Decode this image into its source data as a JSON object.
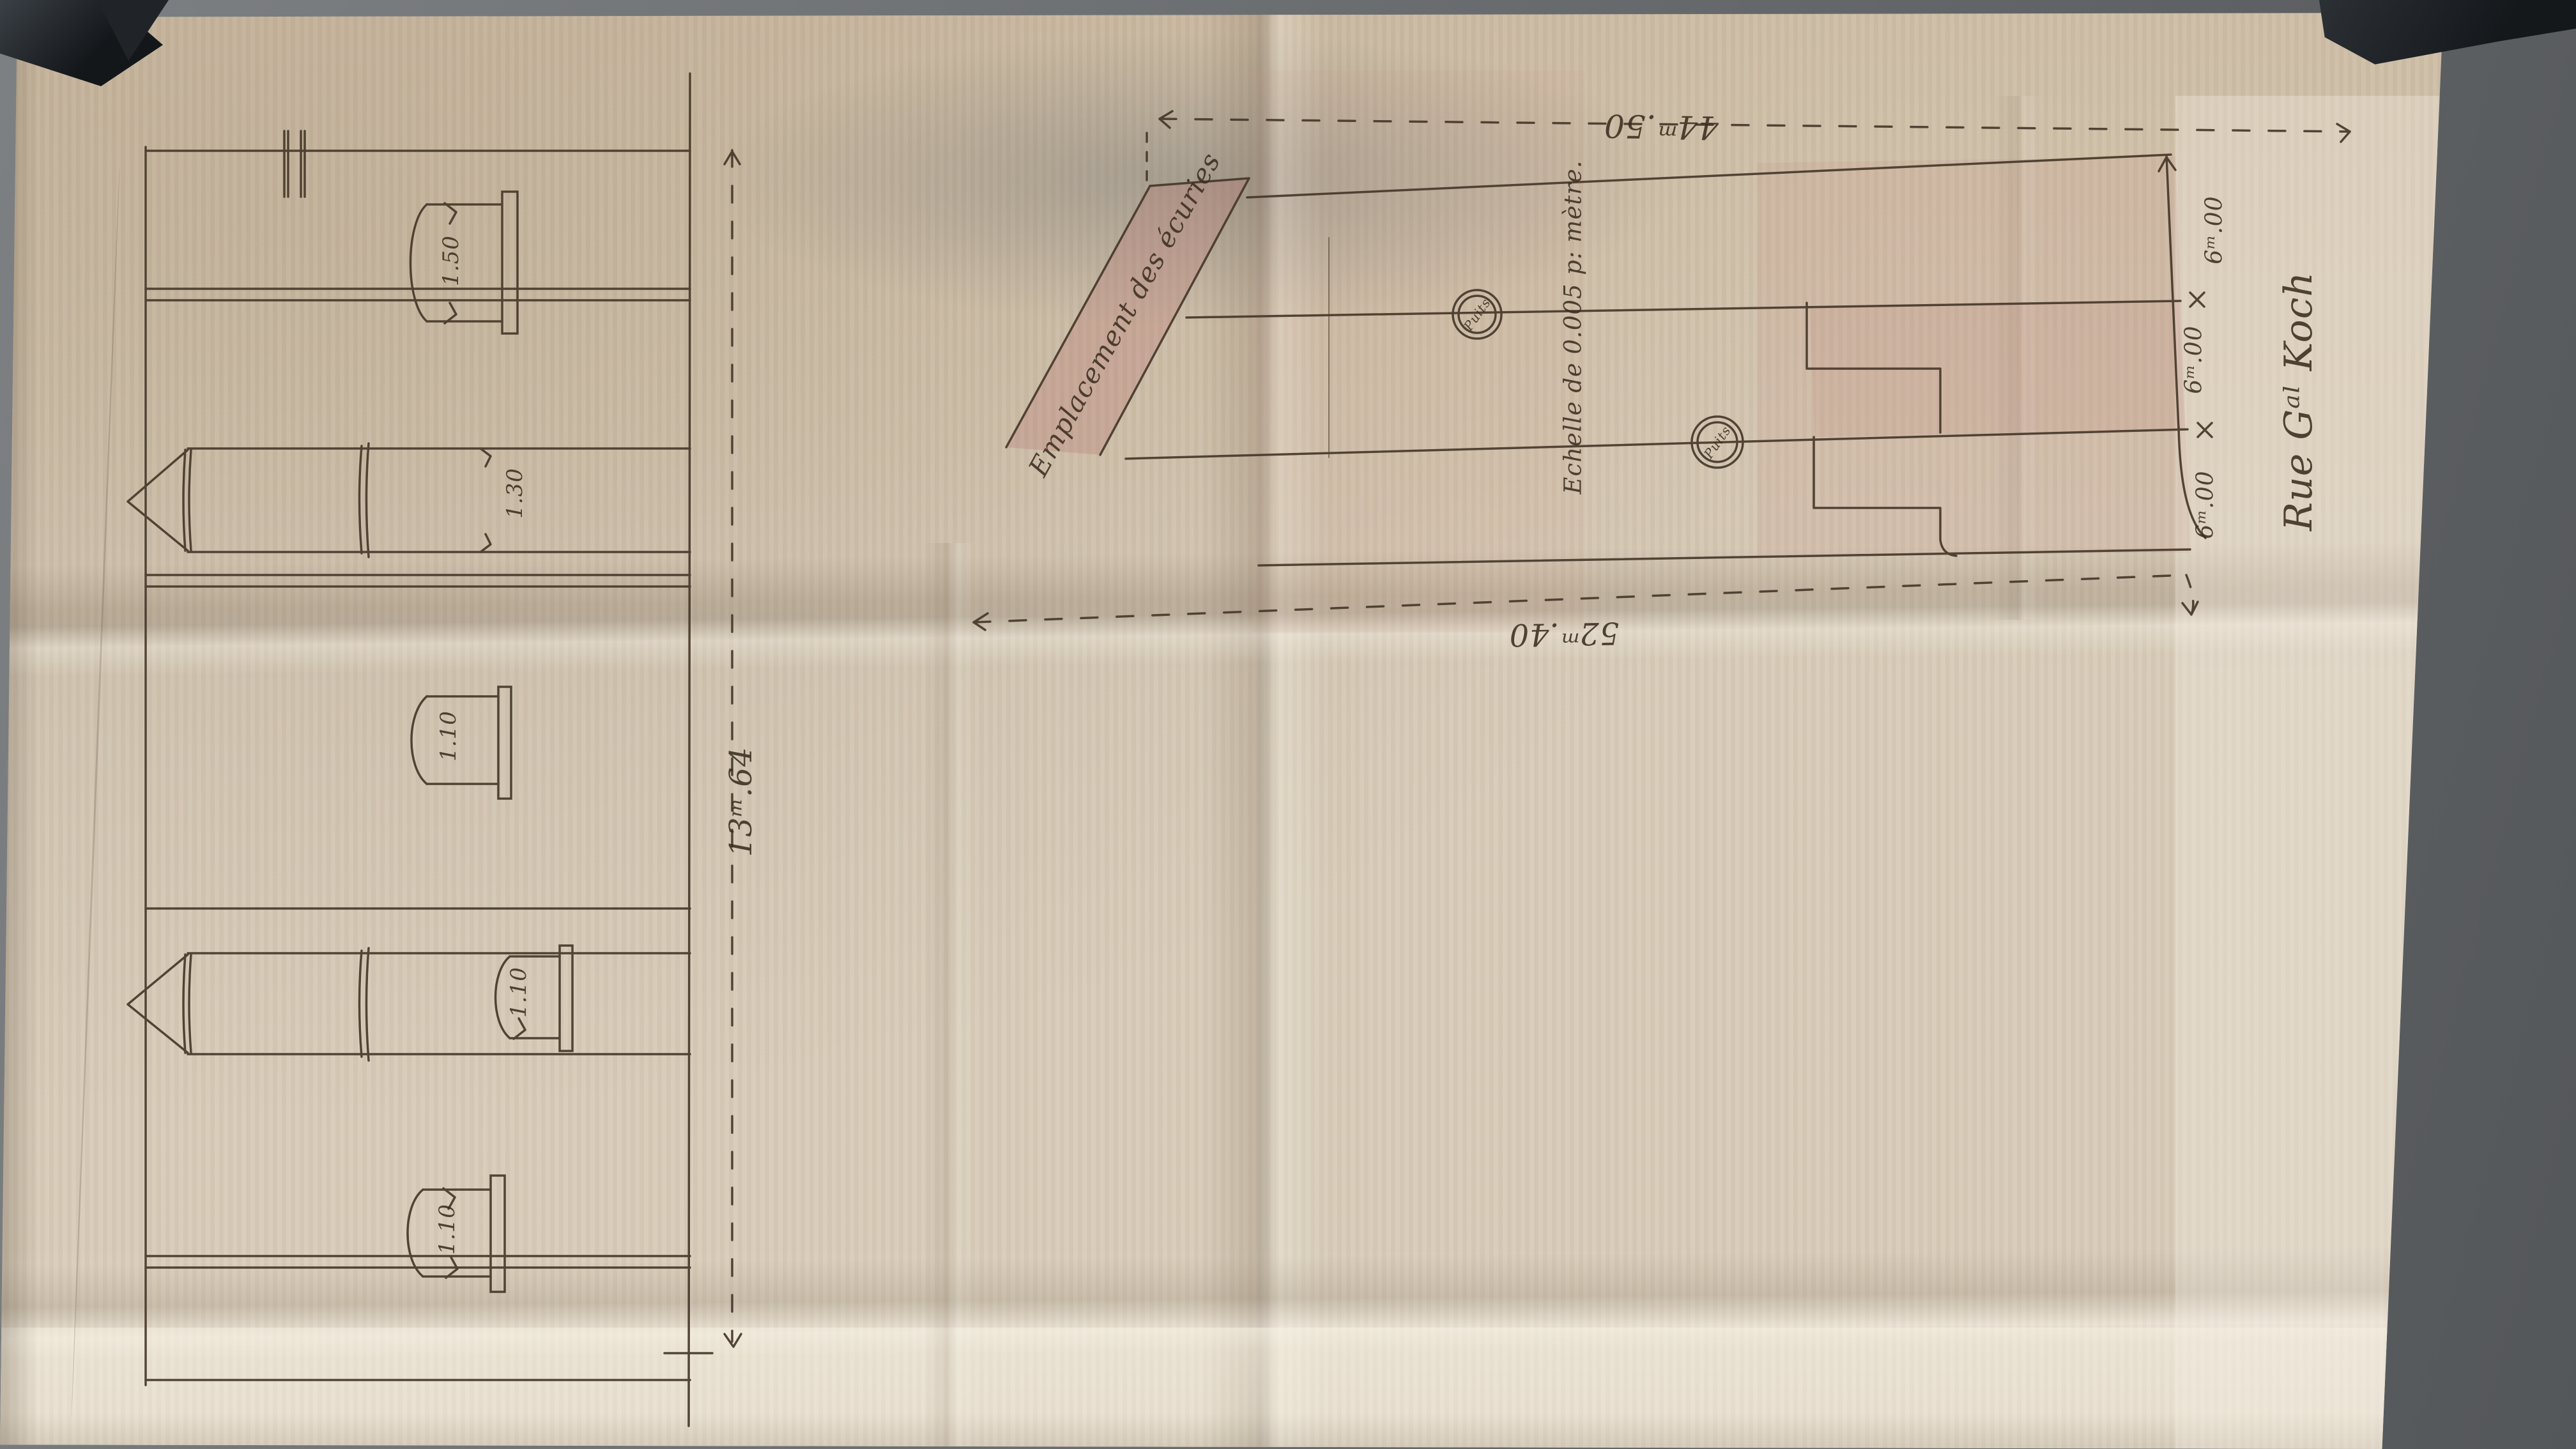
{
  "sheet": {
    "plan": {
      "top_width": "44ᵐ.50",
      "bottom_width": "52ᵐ.40",
      "stables_label": "Emplacement des écuries",
      "scale_note": "Echelle de 0.005 p: mètre.",
      "wells": [
        "Puits",
        "Puits"
      ],
      "street_name": "Rue Gᵃˡ Koch",
      "frontage_segments": [
        "6ᵐ.00",
        "6ᵐ.00",
        "6ᵐ.00"
      ]
    },
    "elevation": {
      "overall_width": "13ᵐ.64",
      "chimney_width": "1.30",
      "vat_labels": [
        "1.50",
        "1.10",
        "1.10",
        "1.10"
      ]
    }
  },
  "colors": {
    "ink": "#46382a",
    "paper": "#d7cbb8",
    "table": "#696c6f",
    "wash_pink": "#c98f85",
    "clamp": "#1c2024"
  }
}
